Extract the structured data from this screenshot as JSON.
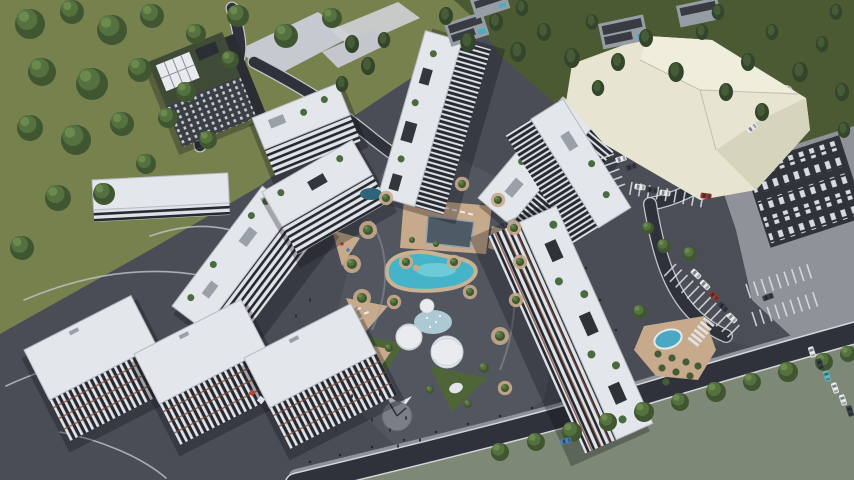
{
  "scene": {
    "alt": "Aerial 3D architectural rendering of a residential complex: white high-rise apartment towers with rooftop gardens arranged around a landscaped courtyard with a turquoise lagoon pool, sunken pool deck, white lattice domes, playgrounds and a circular plaza structure; dark asphalt roads and plazas, striped parking lots with cars, three parallel white slab buildings at lower left, a dark tower on a green hill with round trees at upper left, small villas and conifer woodland at top, a large cream warehouse at upper right and an existing dark roofed building at right",
    "colors": {
      "grass_light": "#77814e",
      "grass_dark": "#4c5a33",
      "tree_round_dark": "#3f5631",
      "tree_round_mid": "#55713f",
      "tree_round_light": "#6b8a4e",
      "conifer_dark": "#33452a",
      "conifer_mid": "#465c38",
      "asphalt_base": "#45484f",
      "plaza": "#4a4d56",
      "courtyard": "#52565f",
      "parking_asphalt": "#4b4e57",
      "road_dark": "#2f323a",
      "road_edge": "#d3d6da",
      "curb": "#c2c5ca",
      "sidewalk": "#8e9299",
      "pavement_light": "#8f9298",
      "sage": "#7e8877",
      "apron": "#c6c9cf",
      "roof_white": "#e3e6ea",
      "facade_white": "#dfe2e7",
      "facade_dark": "#26292f",
      "parapet": "#b7bbc2",
      "green_roof": "#3f4a37",
      "panel_white": "#e8eaee",
      "accent_red": "#7c4636",
      "sand": "#c6aa8b",
      "pool_dark": "#4e5a64",
      "lagoon": "#45b4c8",
      "lagoon_light": "#7fd3de",
      "splash": "#b5d3de",
      "dome": "#e9ebef",
      "pond": "#4aa8c2",
      "warehouse": "#e7e5d2",
      "warehouse_light": "#efeedd",
      "warehouse_dark": "#d6d4bd",
      "villa_wall": "#979da5",
      "villa_roof": "#383c42",
      "villa_pool": "#45aec6",
      "existing_dark": "#30333a",
      "unit_white": "#d7dade",
      "structure_gray": "#7a7e86",
      "car_white": "#e8eaed",
      "car_dark": "#3a3e46",
      "car_red": "#8e3a34",
      "car_blue": "#4a7fb5",
      "car_teal": "#5fb8c4",
      "shadow": "rgba(16,18,24,0.30)"
    },
    "vegetation": {
      "round_trees": [
        [
          30,
          24,
          15
        ],
        [
          72,
          12,
          12
        ],
        [
          112,
          30,
          15
        ],
        [
          152,
          16,
          12
        ],
        [
          196,
          34,
          10
        ],
        [
          42,
          72,
          14
        ],
        [
          92,
          84,
          16
        ],
        [
          140,
          70,
          12
        ],
        [
          186,
          92,
          10
        ],
        [
          30,
          128,
          13
        ],
        [
          76,
          140,
          15
        ],
        [
          122,
          124,
          12
        ],
        [
          168,
          118,
          10
        ],
        [
          58,
          198,
          13
        ],
        [
          104,
          194,
          11
        ],
        [
          22,
          248,
          12
        ],
        [
          146,
          164,
          10
        ],
        [
          238,
          16,
          11
        ],
        [
          286,
          36,
          12
        ],
        [
          332,
          18,
          10
        ],
        [
          230,
          60,
          9
        ],
        [
          208,
          140,
          9
        ]
      ],
      "conifer_trees": [
        [
          446,
          16,
          9
        ],
        [
          468,
          42,
          10
        ],
        [
          496,
          22,
          9
        ],
        [
          518,
          52,
          10
        ],
        [
          544,
          32,
          9
        ],
        [
          572,
          58,
          10
        ],
        [
          592,
          22,
          8
        ],
        [
          618,
          62,
          9
        ],
        [
          646,
          38,
          9
        ],
        [
          676,
          72,
          10
        ],
        [
          702,
          32,
          8
        ],
        [
          726,
          92,
          9
        ],
        [
          748,
          62,
          9
        ],
        [
          772,
          32,
          8
        ],
        [
          800,
          72,
          10
        ],
        [
          822,
          44,
          8
        ],
        [
          842,
          92,
          9
        ],
        [
          836,
          12,
          8
        ],
        [
          762,
          112,
          9
        ],
        [
          718,
          12,
          8
        ],
        [
          522,
          8,
          8
        ],
        [
          598,
          88,
          8
        ],
        [
          844,
          130,
          8
        ],
        [
          352,
          44,
          9
        ],
        [
          368,
          66,
          9
        ],
        [
          342,
          84,
          8
        ],
        [
          384,
          40,
          8
        ]
      ],
      "street_trees": [
        [
          500,
          452,
          9
        ],
        [
          536,
          442,
          9
        ],
        [
          572,
          432,
          10
        ],
        [
          608,
          422,
          9
        ],
        [
          644,
          412,
          10
        ],
        [
          680,
          402,
          9
        ],
        [
          716,
          392,
          10
        ],
        [
          752,
          382,
          9
        ],
        [
          788,
          372,
          10
        ],
        [
          824,
          362,
          9
        ],
        [
          848,
          354,
          8
        ],
        [
          640,
          312,
          7
        ],
        [
          664,
          246,
          7
        ],
        [
          690,
          254,
          7
        ],
        [
          648,
          228,
          6
        ]
      ],
      "courtyard_trees": [
        [
          362,
          298,
          5,
          1
        ],
        [
          352,
          264,
          5,
          1
        ],
        [
          368,
          230,
          5,
          1
        ],
        [
          386,
          198,
          4,
          1
        ],
        [
          462,
          184,
          4,
          1
        ],
        [
          498,
          200,
          4,
          1
        ],
        [
          514,
          228,
          4,
          1
        ],
        [
          520,
          262,
          4,
          1
        ],
        [
          516,
          300,
          4,
          1
        ],
        [
          500,
          336,
          5,
          1
        ],
        [
          484,
          368,
          5,
          0
        ],
        [
          394,
          302,
          4,
          1
        ],
        [
          406,
          262,
          4,
          1
        ],
        [
          454,
          262,
          4,
          1
        ],
        [
          470,
          292,
          4,
          1
        ],
        [
          436,
          244,
          3,
          0
        ],
        [
          412,
          240,
          3,
          0
        ],
        [
          389,
          348,
          4,
          0
        ],
        [
          430,
          390,
          4,
          0
        ],
        [
          468,
          404,
          4,
          0
        ],
        [
          505,
          388,
          4,
          1
        ]
      ],
      "bushes": [
        [
          658,
          354
        ],
        [
          672,
          358
        ],
        [
          686,
          362
        ],
        [
          698,
          366
        ],
        [
          662,
          368
        ],
        [
          676,
          372
        ],
        [
          690,
          376
        ],
        [
          666,
          382
        ]
      ]
    },
    "vehicles": {
      "cars": [
        [
          640,
          187,
          8,
          "white"
        ],
        [
          652,
          190,
          8,
          "dark"
        ],
        [
          665,
          193,
          8,
          "white"
        ],
        [
          706,
          196,
          8,
          "red"
        ],
        [
          696,
          274,
          44,
          "white"
        ],
        [
          705,
          285,
          44,
          "white"
        ],
        [
          714,
          296,
          44,
          "red"
        ],
        [
          723,
          307,
          44,
          "dark"
        ],
        [
          732,
          318,
          44,
          "white"
        ],
        [
          812,
          352,
          72,
          "white"
        ],
        [
          820,
          364,
          72,
          "dark"
        ],
        [
          827,
          376,
          72,
          "teal"
        ],
        [
          835,
          388,
          72,
          "white"
        ],
        [
          843,
          400,
          72,
          "white"
        ],
        [
          850,
          411,
          72,
          "dark"
        ],
        [
          621,
          159,
          -18,
          "white"
        ],
        [
          631,
          167,
          -18,
          "dark"
        ],
        [
          768,
          297,
          -20,
          "dark"
        ],
        [
          566,
          441,
          -14,
          "blue"
        ],
        [
          752,
          128,
          -38,
          "white"
        ]
      ]
    },
    "parking": {
      "rows": [
        {
          "x": 676,
          "y": 264,
          "dir": 44,
          "n": 12,
          "gap": 8,
          "len": 17
        },
        {
          "x": 746,
          "y": 284,
          "dir": -18,
          "n": 9,
          "gap": 8,
          "len": 15
        },
        {
          "x": 752,
          "y": 312,
          "dir": -18,
          "n": 9,
          "gap": 8,
          "len": 15
        },
        {
          "x": 614,
          "y": 154,
          "dir": 70,
          "n": 5,
          "gap": 8,
          "len": 14
        },
        {
          "x": 632,
          "y": 182,
          "dir": 10,
          "n": 9,
          "gap": 9,
          "len": 13
        }
      ],
      "crosswalk": {
        "x": 714,
        "y": 326,
        "dir": 128,
        "n": 6,
        "gap": 5,
        "len": 13,
        "w": 3
      }
    },
    "figures": [
      [
        352,
        396
      ],
      [
        360,
        404
      ],
      [
        344,
        410
      ],
      [
        372,
        420
      ],
      [
        390,
        430
      ],
      [
        406,
        418
      ],
      [
        380,
        394
      ],
      [
        336,
        430
      ],
      [
        320,
        418
      ],
      [
        398,
        446
      ],
      [
        420,
        440
      ],
      [
        310,
        300
      ],
      [
        296,
        316
      ]
    ],
    "bollards": [
      [
        310,
        462
      ],
      [
        340,
        455
      ],
      [
        372,
        447
      ],
      [
        404,
        440
      ],
      [
        436,
        432
      ],
      [
        468,
        424
      ],
      [
        500,
        416
      ],
      [
        532,
        408
      ],
      [
        560,
        400
      ],
      [
        586,
        268
      ],
      [
        600,
        300
      ],
      [
        616,
        330
      ]
    ]
  }
}
